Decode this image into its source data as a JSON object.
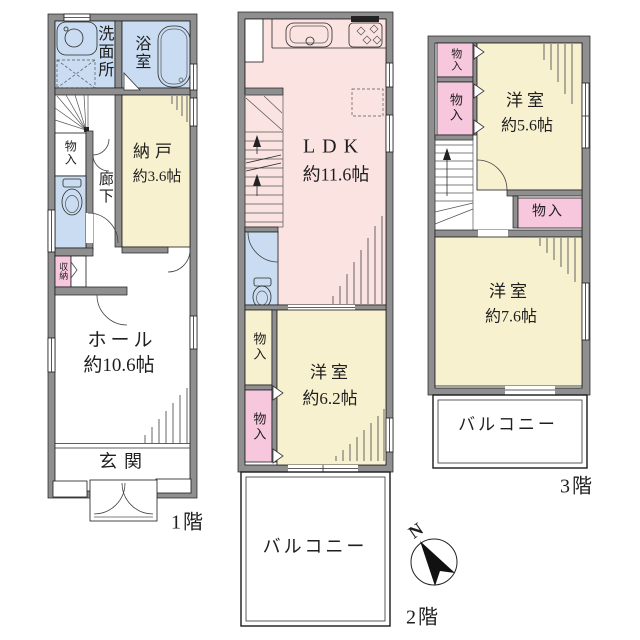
{
  "colors": {
    "wall": "#8f8f8f",
    "room_cream": "#f8f1cf",
    "ldk_pink": "#fbe3e1",
    "closet_pink": "#f7c7de",
    "water_blue": "#c9dcf1",
    "outline": "#1a1a1a"
  },
  "floor1": {
    "label": "1階",
    "washroom": "洗面所",
    "bathroom": "浴室",
    "storage_room": "納戸",
    "storage_room_size": "約3.6帖",
    "closet": "物入",
    "hallway": "廊下",
    "storage": "収納",
    "hall": "ホール",
    "hall_size": "約10.6帖",
    "entrance": "玄関"
  },
  "floor2": {
    "label": "2階",
    "ldk": "LDK",
    "ldk_size": "約11.6帖",
    "closet_upper": "物入",
    "closet_lower": "物入",
    "room": "洋室",
    "room_size": "約6.2帖",
    "balcony": "バルコニー"
  },
  "floor3": {
    "label": "3階",
    "closet_top": "物入",
    "closet_mid": "物入",
    "closet_inner": "物入",
    "room1": "洋室",
    "room1_size": "約5.6帖",
    "room2": "洋室",
    "room2_size": "約7.6帖",
    "balcony": "バルコニー"
  },
  "compass": {
    "north": "N"
  }
}
